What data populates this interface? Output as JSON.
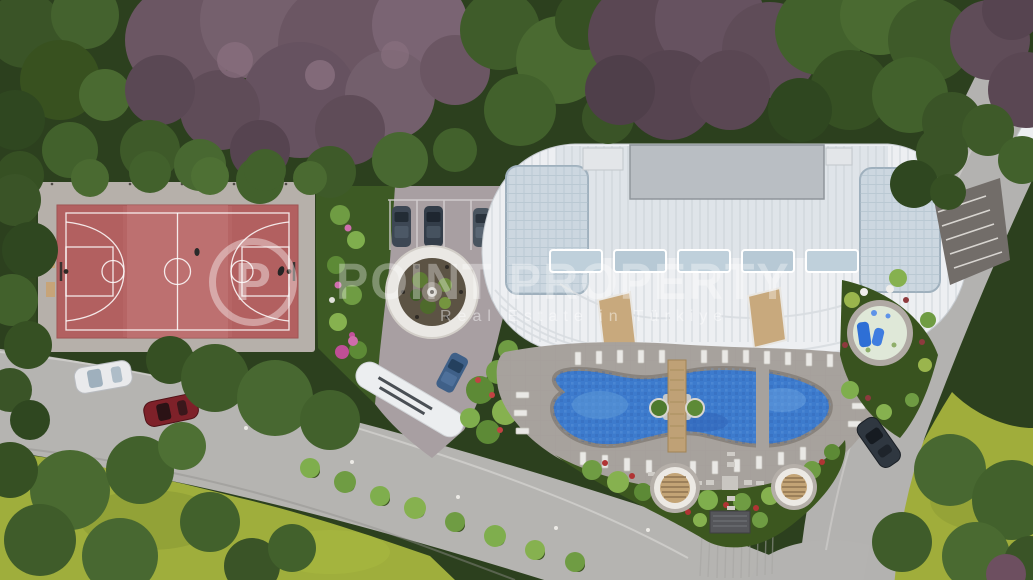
{
  "watermark": {
    "logo_letter": "P",
    "title": "POINT PROPERTY",
    "subtitle": "Real Estate in Türkiye"
  },
  "scene": {
    "type": "aerial-architectural-render",
    "site_features": [
      "basketball-court",
      "fountain-plaza",
      "parking-bays",
      "entrance-canopy",
      "curved-apartment-building",
      "swimming-pool",
      "pool-bridge",
      "sun-loungers",
      "round-pergolas",
      "kids-splash-pool",
      "entrance-gate",
      "garden-paths",
      "access-road",
      "perimeter-road",
      "lawns",
      "blossom-trees"
    ],
    "vehicles": {
      "white_car": "#e9eaec",
      "red_car": "#7e2129",
      "parked_cars": [
        "#3d4754",
        "#333d49",
        "#49545f"
      ],
      "blue_parked_car": "#3f6088",
      "dark_car": "#2f3740"
    },
    "palette": {
      "tree_green": "#42612c",
      "blossom_purple": "#6b5663",
      "lawn_green": "#9fae3c",
      "road_gray": "#b5b4b1",
      "court_red": "#b66565",
      "pool_blue": "#3d7bcd",
      "building_white": "#edeff2",
      "deck_gray": "#a7a29d",
      "watermark_white": "rgba(255,255,255,0.35)"
    }
  }
}
